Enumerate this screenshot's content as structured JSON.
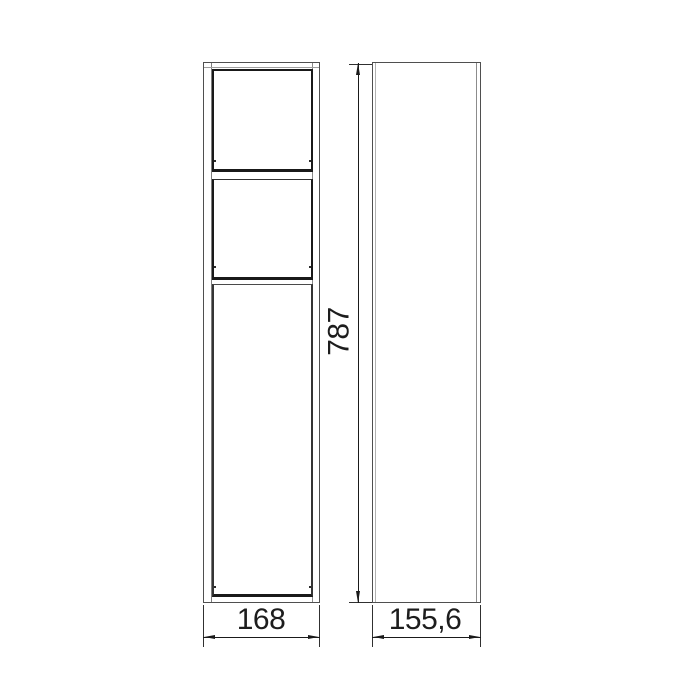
{
  "drawing": {
    "labels": {
      "height": "787",
      "front_width": "168",
      "side_depth": "155,6"
    },
    "views": {
      "front": {
        "sections": [
          "open-niche",
          "drawer-front",
          "door-front"
        ]
      },
      "side": {
        "sections": [
          "side-panel"
        ]
      }
    },
    "colors": {
      "line_strong": "#191919",
      "line_medium": "#4f4f4f",
      "line_light": "#9d9d9d",
      "text": "#1d1d1d",
      "background": "#ffffff"
    }
  }
}
